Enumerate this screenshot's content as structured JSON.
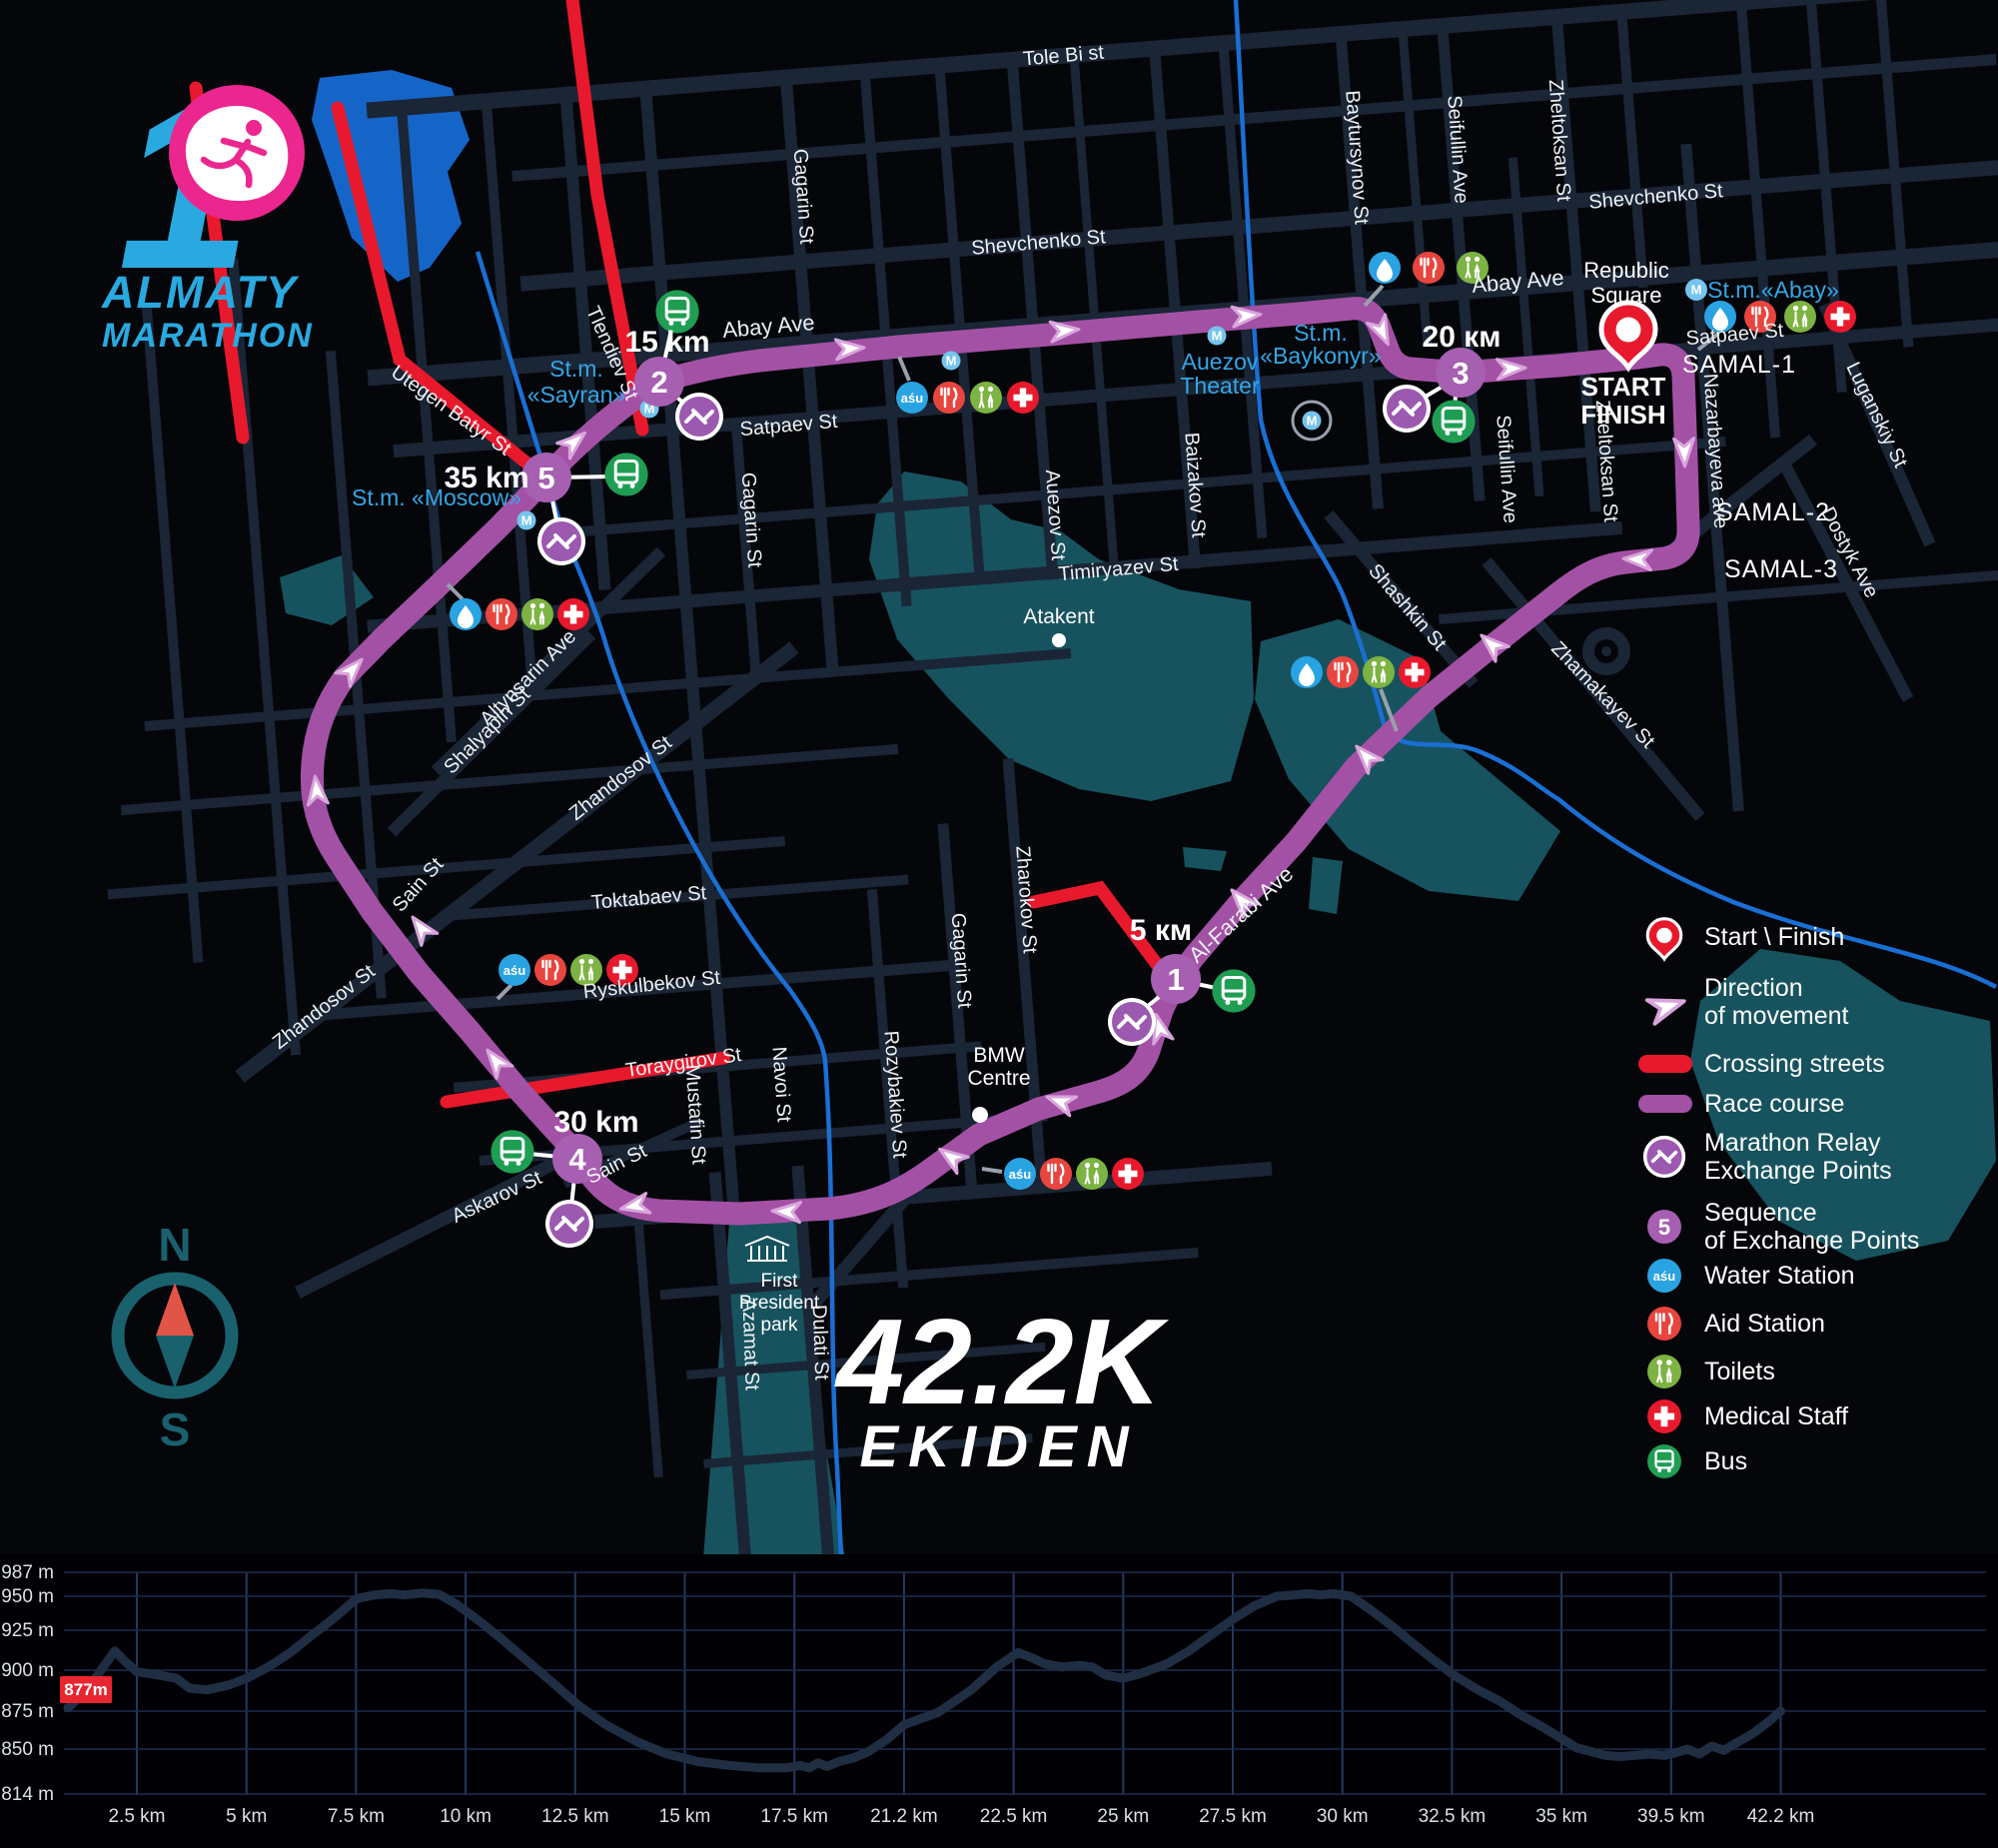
{
  "logo": {
    "number": "1",
    "line1": "ALMATY",
    "line2": "MARATHON"
  },
  "race_title": {
    "distance": "42.2K",
    "name": "EKIDEN"
  },
  "compass": {
    "n": "N",
    "s": "S"
  },
  "start_finish": {
    "place1": "Republic",
    "place2": "Square",
    "l1": "START",
    "l2": "FINISH"
  },
  "km_markers": {
    "k5": "5 км",
    "k15": "15 km",
    "k20": "20 км",
    "k30": "30 km",
    "k35": "35 km"
  },
  "exchange_points": {
    "p1": "1",
    "p2": "2",
    "p3": "3",
    "p4": "4",
    "p5": "5"
  },
  "metro_label": "M",
  "water_brand": "aśu",
  "stations": {
    "sayran1": "St.m.",
    "sayran2": "«Sayran»",
    "moscow": "St.m. «Moscow»",
    "baykonyr1": "St.m.",
    "baykonyr2": "«Baykonyr»",
    "abay": "St.m.«Abay»",
    "auezov1": "Auezov",
    "auezov2": "Theater"
  },
  "places": {
    "atakent": "Atakent",
    "bmw1": "BMW",
    "bmw2": "Centre",
    "park1": "First",
    "park2": "President",
    "park3": "park",
    "samal1": "SAMAL-1",
    "samal2": "SAMAL-2",
    "samal3": "SAMAL-3"
  },
  "streets": {
    "tole_bi": "Tole Bi st",
    "shevchenko": "Shevchenko St",
    "abay": "Abay Ave",
    "satpaev": "Satpaev St",
    "timiryazev": "Timiryazev St",
    "gagarin": "Gagarin St",
    "auezov": "Auezov St",
    "baizakov": "Baizakov St",
    "baytursynov": "Baytursynov St",
    "seifullin": "Seifullin Ave",
    "zheltoksan": "Zheltoksan St",
    "nazarbayeva": "Nazarbayeva ave",
    "luganskiy": "Luganskiy St",
    "dostyk": "Dostyk Ave",
    "zhamakayev": "Zhamakayev St",
    "shashkin": "Shashkin St",
    "zharokov": "Zharokov St",
    "al_farabi": "Al-Farabi Ave",
    "altynsarin": "Altynsarin Ave",
    "shalyapin": "Shalyapin St",
    "zhandosov": "Zhandosov St",
    "sain": "Sain St",
    "toktabaev": "Toktabaev St",
    "ryskulbekov": "Ryskulbekov St",
    "toraygirov": "Toraygirov St",
    "mustafin": "Mustafin St",
    "navoi": "Navoi St",
    "rozybakiev": "Rozybakiev St",
    "azamat": "Azamat St",
    "dulati": "Dulati St",
    "askarov": "Askarov St",
    "utegen_batyr": "Utegen Batyr St",
    "tlendiev": "Tlendiev St"
  },
  "legend": {
    "start_finish": "Start \\ Finish",
    "direction1": "Direction",
    "direction2": "of movement",
    "crossing": "Crossing streets",
    "course": "Race course",
    "relay1": "Marathon Relay",
    "relay2": "Exchange Points",
    "seq_badge": "5",
    "sequence1": "Sequence",
    "sequence2": "of Exchange Points",
    "water": "Water Station",
    "aid": "Aid Station",
    "toilets": "Toilets",
    "medical": "Medical Staff",
    "bus": "Bus"
  },
  "colors": {
    "course": "#a351a5",
    "crossing": "#e8192c",
    "water": "#2aa3e2",
    "aid": "#e8453f",
    "toilets": "#7cb342",
    "medical": "#e8192c",
    "bus": "#1f9e53",
    "exchange": "#a75fb2",
    "park": "#17535e",
    "river": "#1a6fd4",
    "logo_blue": "#2aa9e0",
    "logo_pink": "#ec268f"
  },
  "chart_data": {
    "type": "line",
    "ylabel": "elevation (m)",
    "xlabel": "distance (km)",
    "start_badge": "877m",
    "y_ticks": [
      {
        "label": "987 m",
        "m": 987
      },
      {
        "label": "950 m",
        "m": 950
      },
      {
        "label": "925 m",
        "m": 925
      },
      {
        "label": "900 m",
        "m": 900
      },
      {
        "label": "875 m",
        "m": 875
      },
      {
        "label": "850 m",
        "m": 850
      },
      {
        "label": "814 m",
        "m": 814
      }
    ],
    "x_ticks": [
      {
        "label": "2.5 km",
        "km": 2.5
      },
      {
        "label": "5 km",
        "km": 5
      },
      {
        "label": "7.5 km",
        "km": 7.5
      },
      {
        "label": "10 km",
        "km": 10
      },
      {
        "label": "12.5 km",
        "km": 12.5
      },
      {
        "label": "15 km",
        "km": 15
      },
      {
        "label": "17.5 km",
        "km": 17.5
      },
      {
        "label": "21.2 km",
        "km": 21.2
      },
      {
        "label": "22.5 km",
        "km": 22.5
      },
      {
        "label": "25 km",
        "km": 25
      },
      {
        "label": "27.5 km",
        "km": 27.5
      },
      {
        "label": "30 km",
        "km": 30
      },
      {
        "label": "32.5 km",
        "km": 32.5
      },
      {
        "label": "35 km",
        "km": 35
      },
      {
        "label": "39.5 km",
        "km": 39.5
      },
      {
        "label": "42.2 km",
        "km": 42.2
      }
    ],
    "profile_km_m": [
      [
        0,
        877
      ],
      [
        0.7,
        888
      ],
      [
        1.2,
        900
      ],
      [
        1.7,
        912
      ],
      [
        2.1,
        905
      ],
      [
        2.5,
        899
      ],
      [
        3,
        897
      ],
      [
        3.4,
        895
      ],
      [
        3.7,
        889
      ],
      [
        4.1,
        888
      ],
      [
        4.6,
        891
      ],
      [
        5,
        895
      ],
      [
        5.5,
        902
      ],
      [
        6,
        911
      ],
      [
        6.5,
        922
      ],
      [
        7,
        934
      ],
      [
        7.5,
        948
      ],
      [
        7.9,
        952
      ],
      [
        8.3,
        954
      ],
      [
        8.6,
        952
      ],
      [
        9,
        955
      ],
      [
        9.4,
        953
      ],
      [
        9.8,
        944
      ],
      [
        10.3,
        932
      ],
      [
        10.8,
        920
      ],
      [
        11.4,
        906
      ],
      [
        12,
        892
      ],
      [
        12.6,
        878
      ],
      [
        13.2,
        866
      ],
      [
        13.9,
        855
      ],
      [
        14.6,
        846
      ],
      [
        15.3,
        840
      ],
      [
        16,
        837
      ],
      [
        16.7,
        835
      ],
      [
        17.3,
        835
      ],
      [
        17.7,
        837
      ],
      [
        18,
        835
      ],
      [
        18.3,
        839
      ],
      [
        18.6,
        836
      ],
      [
        19,
        840
      ],
      [
        19.5,
        843
      ],
      [
        20,
        848
      ],
      [
        20.6,
        856
      ],
      [
        21.2,
        866
      ],
      [
        21.6,
        874
      ],
      [
        22,
        888
      ],
      [
        22.3,
        902
      ],
      [
        22.6,
        911
      ],
      [
        22.9,
        908
      ],
      [
        23.2,
        904
      ],
      [
        23.6,
        902
      ],
      [
        24,
        903
      ],
      [
        24.3,
        902
      ],
      [
        24.6,
        897
      ],
      [
        25,
        895
      ],
      [
        25.4,
        898
      ],
      [
        26,
        904
      ],
      [
        26.5,
        912
      ],
      [
        27,
        922
      ],
      [
        27.5,
        933
      ],
      [
        28,
        943
      ],
      [
        28.5,
        950
      ],
      [
        28.9,
        952
      ],
      [
        29.2,
        954
      ],
      [
        29.5,
        952
      ],
      [
        29.8,
        954
      ],
      [
        30.2,
        950
      ],
      [
        30.6,
        941
      ],
      [
        31.1,
        929
      ],
      [
        31.6,
        917
      ],
      [
        32.1,
        906
      ],
      [
        32.6,
        896
      ],
      [
        33.1,
        888
      ],
      [
        33.6,
        881
      ],
      [
        34.1,
        872
      ],
      [
        34.6,
        864
      ],
      [
        35.1,
        856
      ],
      [
        35.6,
        851
      ],
      [
        36.2,
        848
      ],
      [
        36.8,
        845
      ],
      [
        37.4,
        844
      ],
      [
        38,
        845
      ],
      [
        38.6,
        846
      ],
      [
        39.2,
        845
      ],
      [
        39.6,
        847
      ],
      [
        39.9,
        850
      ],
      [
        40.2,
        846
      ],
      [
        40.5,
        852
      ],
      [
        40.8,
        849
      ],
      [
        41.1,
        854
      ],
      [
        41.5,
        860
      ],
      [
        41.9,
        868
      ],
      [
        42.2,
        875
      ]
    ]
  }
}
